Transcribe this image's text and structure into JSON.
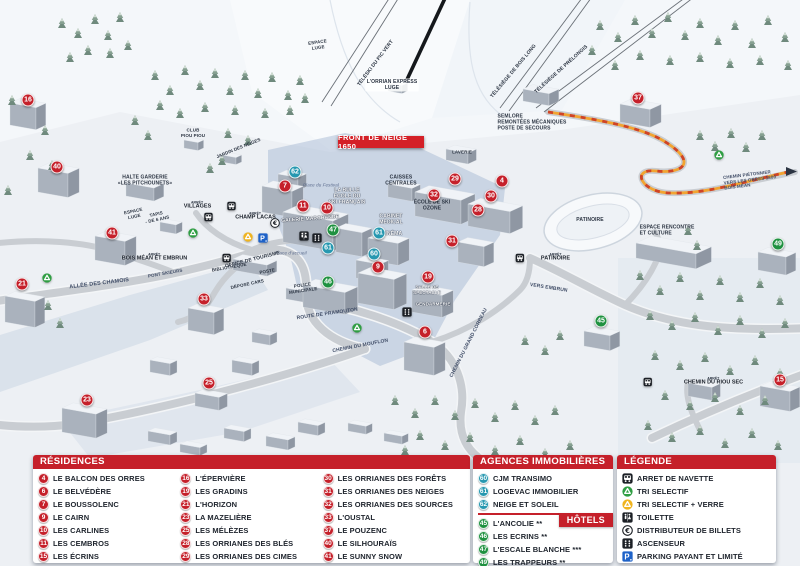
{
  "banner": {
    "text": "FRONT DE NEIGE 1650"
  },
  "stop_prefix": "ARRÊT",
  "colors": {
    "red": "#c5202a",
    "teal": "#2798b0",
    "green": "#1f9140",
    "banner_red": "#d42027"
  },
  "panels": {
    "residences": {
      "title": "RÉSIDENCES",
      "columns": [
        [
          {
            "n": "4",
            "label": "LE BALCON DES ORRES"
          },
          {
            "n": "6",
            "label": "LE BELVÉDÈRE"
          },
          {
            "n": "7",
            "label": "LE BOUSSOLENC"
          },
          {
            "n": "9",
            "label": "LE CAIRN"
          },
          {
            "n": "10",
            "label": "LES CARLINES"
          },
          {
            "n": "11",
            "label": "LES CEMBROS"
          },
          {
            "n": "15",
            "label": "LES ÉCRINS"
          }
        ],
        [
          {
            "n": "16",
            "label": "L'ÉPERVIÈRE"
          },
          {
            "n": "19",
            "label": "LES GRADINS"
          },
          {
            "n": "21",
            "label": "L'HORIZON"
          },
          {
            "n": "23",
            "label": "LA MAZELIÈRE"
          },
          {
            "n": "25",
            "label": "LES MÉLÈZES"
          },
          {
            "n": "28",
            "label": "LES ORRIANES DES BLÉS"
          },
          {
            "n": "29",
            "label": "LES ORRIANES DES CIMES"
          }
        ],
        [
          {
            "n": "30",
            "label": "LES ORRIANES DES FORÊTS"
          },
          {
            "n": "31",
            "label": "LES ORRIANES DES NEIGES"
          },
          {
            "n": "32",
            "label": "LES ORRIANES DES SOURCES"
          },
          {
            "n": "33",
            "label": "L'OUSTAL"
          },
          {
            "n": "37",
            "label": "LE POUZENC"
          },
          {
            "n": "40",
            "label": "LE SILHOURAÏS"
          },
          {
            "n": "41",
            "label": "LE SUNNY SNOW"
          }
        ]
      ]
    },
    "agences": {
      "title": "AGENCES IMMOBILIÈRES",
      "items": [
        {
          "n": "60",
          "label": "CJM TRANSIMO"
        },
        {
          "n": "61",
          "label": "LOGEVAC IMMOBILIER"
        },
        {
          "n": "62",
          "label": "NEIGE ET SOLEIL"
        }
      ]
    },
    "hotels": {
      "title": "HÔTELS",
      "items": [
        {
          "n": "45",
          "label": "L'ANCOLIE **"
        },
        {
          "n": "46",
          "label": "LES ECRINS **"
        },
        {
          "n": "47",
          "label": "L'ESCALE BLANCHE ***"
        },
        {
          "n": "49",
          "label": "LES TRAPPEURS **"
        }
      ]
    },
    "legende": {
      "title": "LÉGENDE",
      "items": [
        {
          "icon": "bus-icon",
          "label": "ARRET DE NAVETTE"
        },
        {
          "icon": "recycle-green-icon",
          "label": "TRI SELECTIF"
        },
        {
          "icon": "recycle-yellow-icon",
          "label": "TRI SELECTIF + VERRE"
        },
        {
          "icon": "toilet-icon",
          "label": "TOILETTE"
        },
        {
          "icon": "euro-icon",
          "label": "DISTRIBUTEUR DE BILLETS"
        },
        {
          "icon": "elevator-icon",
          "label": "ASCENSEUR"
        },
        {
          "icon": "parking-icon",
          "label": "PARKING PAYANT ET LIMITÉ"
        }
      ]
    }
  },
  "map": {
    "markers": [
      {
        "n": "16",
        "x": 28,
        "y": 100,
        "t": "r"
      },
      {
        "n": "40",
        "x": 57,
        "y": 167,
        "t": "r"
      },
      {
        "n": "41",
        "x": 112,
        "y": 233,
        "t": "r"
      },
      {
        "n": "21",
        "x": 22,
        "y": 284,
        "t": "r"
      },
      {
        "n": "33",
        "x": 204,
        "y": 299,
        "t": "r"
      },
      {
        "n": "23",
        "x": 87,
        "y": 400,
        "t": "r"
      },
      {
        "n": "25",
        "x": 209,
        "y": 383,
        "t": "r"
      },
      {
        "n": "7",
        "x": 285,
        "y": 186,
        "t": "r"
      },
      {
        "n": "11",
        "x": 303,
        "y": 206,
        "t": "r"
      },
      {
        "n": "10",
        "x": 327,
        "y": 208,
        "t": "r"
      },
      {
        "n": "9",
        "x": 378,
        "y": 267,
        "t": "r"
      },
      {
        "n": "19",
        "x": 428,
        "y": 277,
        "t": "r"
      },
      {
        "n": "6",
        "x": 425,
        "y": 332,
        "t": "r"
      },
      {
        "n": "29",
        "x": 455,
        "y": 179,
        "t": "r"
      },
      {
        "n": "32",
        "x": 434,
        "y": 195,
        "t": "r"
      },
      {
        "n": "4",
        "x": 502,
        "y": 181,
        "t": "r"
      },
      {
        "n": "30",
        "x": 491,
        "y": 196,
        "t": "r"
      },
      {
        "n": "28",
        "x": 478,
        "y": 210,
        "t": "r"
      },
      {
        "n": "31",
        "x": 452,
        "y": 241,
        "t": "r"
      },
      {
        "n": "37",
        "x": 638,
        "y": 98,
        "t": "r"
      },
      {
        "n": "15",
        "x": 780,
        "y": 380,
        "t": "r"
      },
      {
        "n": "62",
        "x": 295,
        "y": 172,
        "t": "a"
      },
      {
        "n": "61",
        "x": 379,
        "y": 233,
        "t": "a"
      },
      {
        "n": "61",
        "x": 328,
        "y": 248,
        "t": "a"
      },
      {
        "n": "60",
        "x": 374,
        "y": 254,
        "t": "a"
      },
      {
        "n": "47",
        "x": 333,
        "y": 230,
        "t": "h"
      },
      {
        "n": "46",
        "x": 328,
        "y": 282,
        "t": "h"
      },
      {
        "n": "49",
        "x": 778,
        "y": 244,
        "t": "h"
      },
      {
        "n": "45",
        "x": 601,
        "y": 321,
        "t": "h"
      }
    ],
    "labels": [
      {
        "t": "TÉLÉSKI DU PIC VERT",
        "x": 374,
        "y": 62,
        "r": -53,
        "s": 5,
        "c": "dark"
      },
      {
        "t": "L'ORRIAN EXPRESS\nLUGE",
        "x": 392,
        "y": 85,
        "r": 0,
        "s": 5,
        "c": "dark",
        "plate": true
      },
      {
        "t": "TÉLÉSIÈGE DE BOIS LONG",
        "x": 512,
        "y": 70,
        "r": -50,
        "s": 5,
        "c": "dark"
      },
      {
        "t": "TÉLÉSIÈGE DE PRÉLONGIS",
        "x": 560,
        "y": 68,
        "r": -42,
        "s": 5,
        "c": "dark"
      },
      {
        "t": "SEMLORE\nREMONTÉES MÉCANIQUES\nPOSTE DE SECOURS",
        "x": 532,
        "y": 123,
        "r": 0,
        "s": 5,
        "c": "dark",
        "a": "left"
      },
      {
        "t": "LAVERIE",
        "x": 462,
        "y": 151,
        "r": 0,
        "s": 4.5,
        "c": "dark"
      },
      {
        "t": "CAISSES\nCENTRALES",
        "x": 401,
        "y": 181,
        "r": 0,
        "s": 5,
        "c": "dark"
      },
      {
        "t": "ÉCOLE DE SKI\nOZONE",
        "x": 432,
        "y": 206,
        "r": 0,
        "s": 5,
        "c": "dark"
      },
      {
        "t": "LA BULLE\nÉCOLE DU\nSKI FRANÇAIS",
        "x": 347,
        "y": 197,
        "r": 0,
        "s": 5,
        "c": "white"
      },
      {
        "t": "GALERIE MARCHANDE",
        "x": 310,
        "y": 217,
        "r": -4,
        "s": 5,
        "c": "white"
      },
      {
        "t": "CABINET\nMÉDICAL",
        "x": 391,
        "y": 220,
        "r": 0,
        "s": 5,
        "c": "white"
      },
      {
        "t": "CINÉMA",
        "x": 392,
        "y": 232,
        "r": 0,
        "s": 5,
        "c": "white"
      },
      {
        "t": "SALLE DE\nSPECTACLE",
        "x": 427,
        "y": 291,
        "r": 0,
        "s": 4.5,
        "c": "white"
      },
      {
        "t": "GENDARMERIE",
        "x": 433,
        "y": 303,
        "r": 0,
        "s": 4.5,
        "c": "white"
      },
      {
        "t": "Place du Festival",
        "x": 321,
        "y": 184,
        "r": 0,
        "s": 4.5,
        "c": "place"
      },
      {
        "t": "Place d'accueil",
        "x": 291,
        "y": 252,
        "r": 0,
        "s": 4.5,
        "c": "place"
      },
      {
        "t": "PONT SKIEURS",
        "x": 165,
        "y": 272,
        "r": -10,
        "s": 4.5,
        "c": "road"
      },
      {
        "t": "ALLÉE DES CHAMOIS",
        "x": 99,
        "y": 282,
        "r": -7,
        "s": 5.5,
        "c": "road"
      },
      {
        "t": "ROUTE DE PRAMOUTON",
        "x": 327,
        "y": 312,
        "r": -8,
        "s": 5,
        "c": "road"
      },
      {
        "t": "CHEMIN DU MOUFLON",
        "x": 360,
        "y": 344,
        "r": -11,
        "s": 5,
        "c": "road"
      },
      {
        "t": "CHEMIN DU GRAND CORBEAU",
        "x": 467,
        "y": 342,
        "r": -63,
        "s": 5,
        "c": "road"
      },
      {
        "t": "VERS EMBRUN",
        "x": 549,
        "y": 286,
        "r": 9,
        "s": 5,
        "c": "road"
      },
      {
        "t": "PATINOIRE",
        "x": 590,
        "y": 218,
        "r": 0,
        "s": 5,
        "c": "dark"
      },
      {
        "t": "ESPACE RENCONTRE\nET CULTURE",
        "x": 667,
        "y": 231,
        "r": 0,
        "s": 5,
        "c": "dark",
        "a": "left"
      },
      {
        "t": "CHEMIN PIÉTONNIER\nVERS LES ORRES 1800\nBOIS MÉAN",
        "x": 750,
        "y": 181,
        "r": -7,
        "s": 4.5,
        "c": "road",
        "a": "left"
      },
      {
        "t": "HALTE GARDERIE\n«LES PITCHOUNETS»",
        "x": 145,
        "y": 181,
        "r": 0,
        "s": 5,
        "c": "dark"
      },
      {
        "t": "ESPACE\nLUGE",
        "x": 134,
        "y": 215,
        "r": -12,
        "s": 4.5,
        "c": "dark"
      },
      {
        "t": "TAPIS\n- DE 6 ANS",
        "x": 157,
        "y": 218,
        "r": -12,
        "s": 4.5,
        "c": "dark"
      },
      {
        "t": "CLUB\nPIOU PIOU",
        "x": 193,
        "y": 134,
        "r": 0,
        "s": 4.5,
        "c": "dark"
      },
      {
        "t": "JARDIN DES NEIGES",
        "x": 238,
        "y": 147,
        "r": -22,
        "s": 4.5,
        "c": "dark"
      },
      {
        "t": "ESPACE\nLUGE",
        "x": 318,
        "y": 46,
        "r": -8,
        "s": 4.5,
        "c": "dark"
      },
      {
        "t": "OFFICE DE TOURISME",
        "x": 252,
        "y": 258,
        "r": -14,
        "s": 5,
        "c": "dark"
      },
      {
        "t": "BIBLIOTHÈQUE",
        "x": 229,
        "y": 266,
        "r": -10,
        "s": 4.5,
        "c": "dark"
      },
      {
        "t": "POSTE",
        "x": 267,
        "y": 270,
        "r": -10,
        "s": 4.5,
        "c": "dark"
      },
      {
        "t": "DÉPOSE CARS",
        "x": 247,
        "y": 283,
        "r": -12,
        "s": 4.5,
        "c": "dark"
      },
      {
        "t": "POLICE\nMUNICIPALE",
        "x": 303,
        "y": 289,
        "r": -8,
        "s": 4.5,
        "c": "dark"
      }
    ],
    "bus_stops": [
      {
        "label": "VILLAGES",
        "x": 203,
        "y": 206,
        "icon_side": "right"
      },
      {
        "label": "CHAMP LACAS",
        "x": 250,
        "y": 217,
        "icon_side": "left"
      },
      {
        "label": "BOIS MÉAN ET EMBRUN",
        "x": 160,
        "y": 258,
        "icon_side": "right"
      },
      {
        "label": "PATINOIRE",
        "x": 550,
        "y": 258,
        "icon_side": "left"
      },
      {
        "label": "CHEMIN DU RIOU SEC",
        "x": 708,
        "y": 382,
        "icon_side": "left"
      }
    ],
    "facilities": [
      {
        "icon": "euro-icon",
        "x": 275,
        "y": 223
      },
      {
        "icon": "recycle-yellow-icon",
        "x": 248,
        "y": 237
      },
      {
        "icon": "parking-icon",
        "x": 263,
        "y": 238
      },
      {
        "icon": "toilet-icon",
        "x": 304,
        "y": 236
      },
      {
        "icon": "elevator-icon",
        "x": 317,
        "y": 238
      },
      {
        "icon": "elevator-icon",
        "x": 407,
        "y": 312
      },
      {
        "icon": "recycle-green-icon",
        "x": 193,
        "y": 233
      },
      {
        "icon": "recycle-green-icon",
        "x": 47,
        "y": 278
      },
      {
        "icon": "recycle-green-icon",
        "x": 357,
        "y": 328
      },
      {
        "icon": "recycle-green-icon",
        "x": 719,
        "y": 155
      }
    ]
  }
}
